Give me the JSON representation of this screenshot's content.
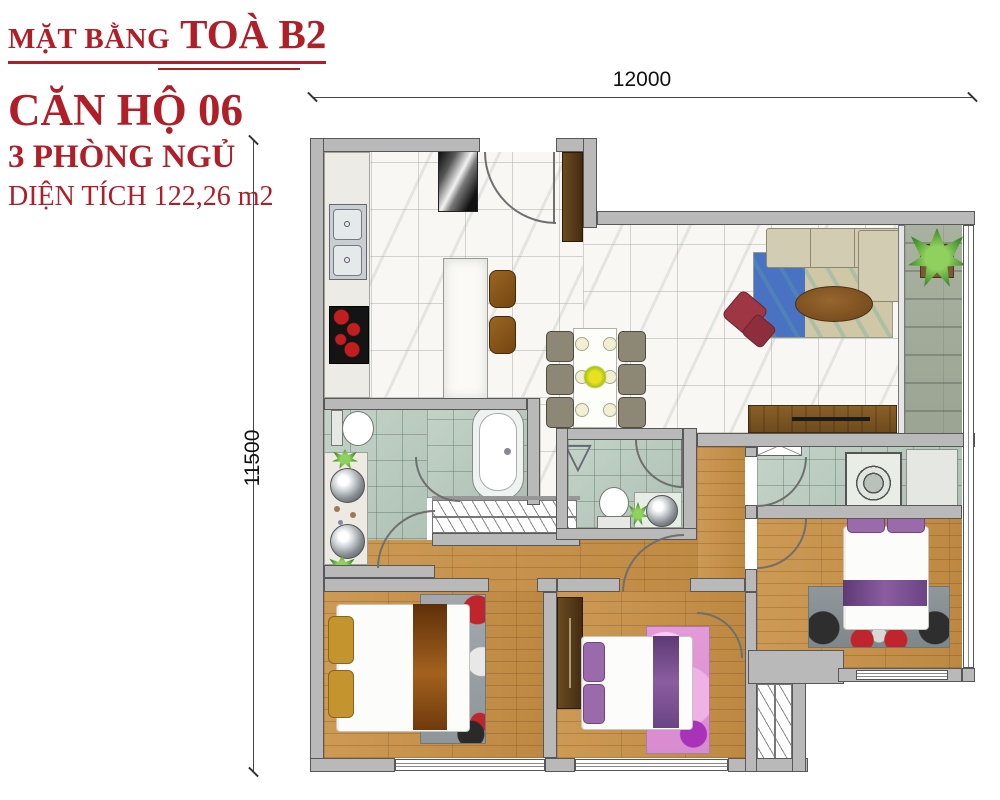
{
  "title": {
    "building_label": "MẶT BẰNG",
    "building_name": "TOÀ B2",
    "unit": "CĂN HỘ 06",
    "bedrooms": "3 PHÒNG NGỦ",
    "area": "DIỆN TÍCH 122,26 m2"
  },
  "dimensions": {
    "width_mm": "12000",
    "height_mm": "11500"
  },
  "icons": {
    "shower_door_symbol": "▽"
  },
  "colors": {
    "accent_red": "#b01e28",
    "wall_gray": "#b9b9b9",
    "wood_floor": "#c8914c",
    "marble_floor": "#f8f7f4",
    "bath_tile_green": "#bccdc2",
    "balcony_stone": "#a9b1a1",
    "rug_blue": "#4a72c2",
    "sofa_beige": "#d2cdb2",
    "armchair_red": "#9e3644",
    "bed_runner_brown": "#8a4a12",
    "bed_runner_purple": "#7d4f94",
    "pillow_gold": "#c4942f",
    "plant_green": "#3e8a28"
  }
}
